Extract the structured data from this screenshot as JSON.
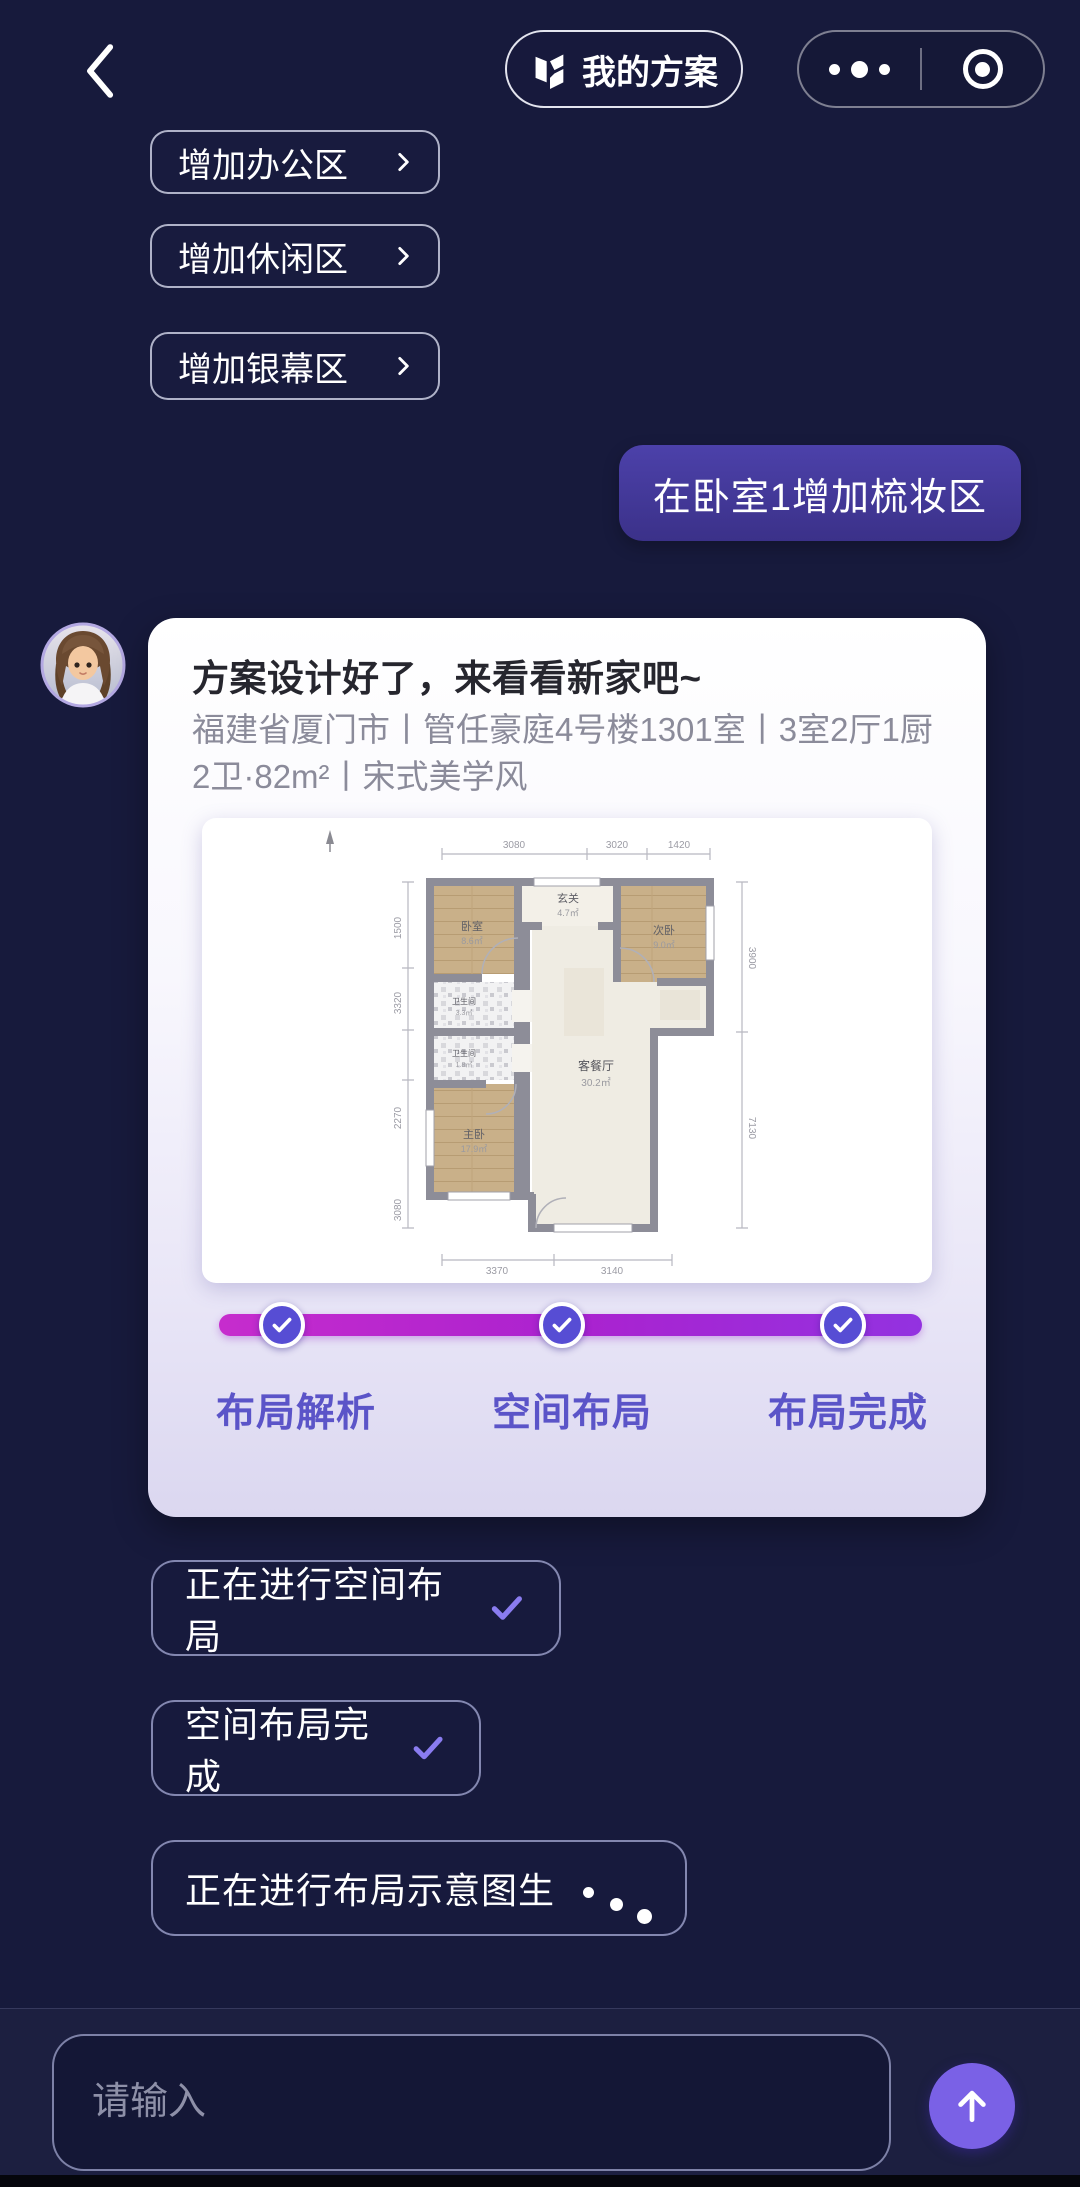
{
  "header": {
    "plan_button": {
      "label": "我的方案"
    },
    "icons": {
      "back": "‹",
      "plan": "folded-floorplan",
      "more": "•••",
      "record": "◉"
    }
  },
  "suggestions": [
    {
      "label": "增加办公区",
      "chevron": "›"
    },
    {
      "label": "增加休闲区",
      "chevron": "›"
    },
    {
      "label": "增加银幕区",
      "chevron": "›"
    }
  ],
  "user_message": {
    "text": "在卧室1增加梳妆区"
  },
  "assistant_card": {
    "title": "方案设计好了，来看看新家吧~",
    "subtitle": "福建省厦门市丨管任豪庭4号楼1301室丨3室2厅1厨2卫·82m²丨宋式美学风",
    "steps": [
      {
        "label": "布局解析",
        "done": true
      },
      {
        "label": "空间布局",
        "done": true
      },
      {
        "label": "布局完成",
        "done": true
      }
    ],
    "floorplan": {
      "compass": "N",
      "rooms": [
        {
          "name": "卧室",
          "area": "8.6㎡"
        },
        {
          "name": "玄关",
          "area": "4.7㎡"
        },
        {
          "name": "次卧",
          "area": "9.0㎡"
        },
        {
          "name": "卫生间",
          "area": "3.3㎡"
        },
        {
          "name": "卫生间",
          "area": "1.8㎡"
        },
        {
          "name": "主卧",
          "area": "17.9㎡"
        },
        {
          "name": "客餐厅",
          "area": "30.2㎡"
        }
      ],
      "dims_top": [
        "3080",
        "3020",
        "1420"
      ],
      "dims_left": [
        "1500",
        "3320",
        "2270",
        "3080"
      ],
      "dims_right": [
        "3900",
        "7130"
      ],
      "dims_bottom": [
        "3370",
        "3140"
      ]
    }
  },
  "status_log": [
    {
      "label": "正在进行空间布局",
      "indicator": "check"
    },
    {
      "label": "空间布局完成",
      "indicator": "check"
    },
    {
      "label": "正在进行布局示意图生",
      "indicator": "loading"
    }
  ],
  "composer": {
    "placeholder": "请输入",
    "send_icon": "↑"
  },
  "colors": {
    "background": "#171A3C",
    "bubble_purple": "#473CA5",
    "card_bg": "#FFFFFF",
    "progress_gradient_start": "#C62CCD",
    "progress_gradient_end": "#9332E0",
    "step_label": "#5B54C8",
    "node_fill": "#574DD4",
    "accent_purple": "#7A61E6",
    "check_purple": "#8A7CF0"
  }
}
